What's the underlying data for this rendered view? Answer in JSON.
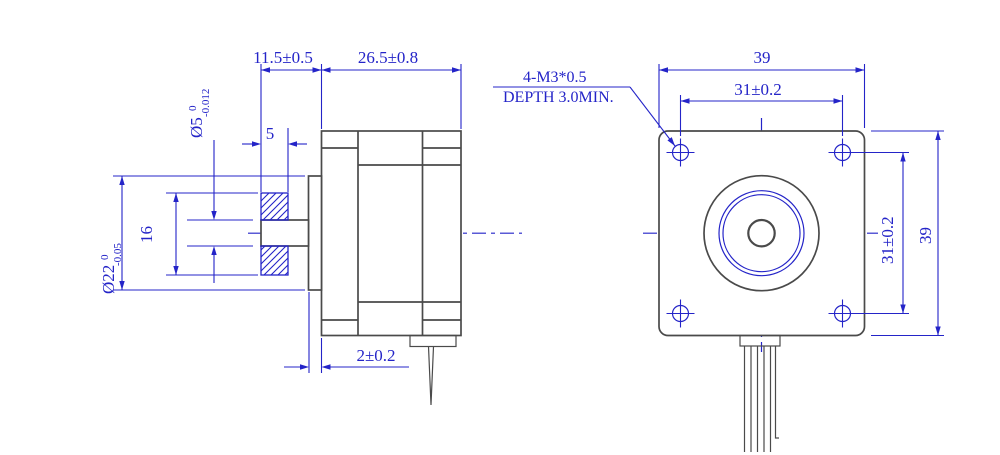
{
  "colors": {
    "geometry": "#4a4a4a",
    "dimension": "#2424c8",
    "background": "#ffffff"
  },
  "side_view": {
    "dims": {
      "shaft_protrusion": "11.5±0.5",
      "body_length": "26.5±0.8",
      "pulley_width": "5",
      "pilot_height": "2±0.2",
      "shaft_dia": "Ø5",
      "shaft_tol_upper": "0",
      "shaft_tol_lower": "-0.012",
      "pilot_dia": "Ø22",
      "pilot_tol_upper": "0",
      "pilot_tol_lower": "-0.05",
      "pulley_od": "16"
    }
  },
  "front_view": {
    "dims": {
      "body_width": "39",
      "body_height": "39",
      "hole_pitch_horizontal": "31±0.2",
      "hole_pitch_vertical": "31±0.2"
    },
    "thread_note": {
      "line1": "4-M3*0.5",
      "line2": "DEPTH 3.0MIN."
    }
  }
}
